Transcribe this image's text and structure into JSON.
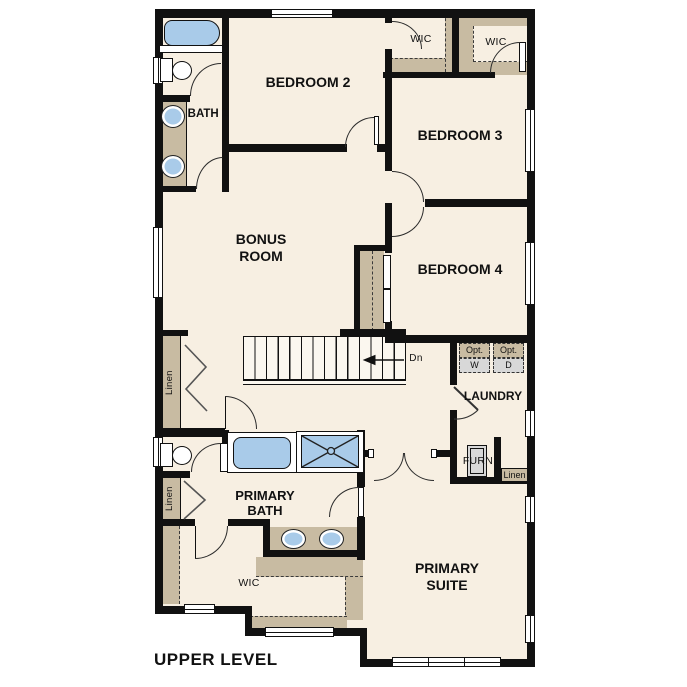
{
  "plan_title": "UPPER LEVEL",
  "labels": {
    "bedroom2": "BEDROOM 2",
    "bedroom3": "BEDROOM 3",
    "bedroom4": "BEDROOM 4",
    "bonus_room": "BONUS ROOM",
    "bath2": "BATH 2",
    "primary_bath": "PRIMARY BATH",
    "primary_suite": "PRIMARY SUITE",
    "laundry": "LAUNDRY",
    "wic_bedroom2": "WIC",
    "wic_bedroom3": "WIC",
    "wic_primary": "WIC",
    "furnace": "FURN",
    "linen_hall": "Linen",
    "linen_bath": "Linen",
    "linen_laundry": "Linen",
    "stairs_down": "Dn",
    "opt_washer_line1": "Opt.",
    "opt_washer_line2": "W",
    "opt_dryer_line1": "Opt.",
    "opt_dryer_line2": "D"
  },
  "colors": {
    "floor": "#f7efe2",
    "wall": "#111111",
    "casework": "#c8bba2",
    "fixture_blue": "#a9cbe9",
    "appliance_gray": "#d8d8d8"
  }
}
